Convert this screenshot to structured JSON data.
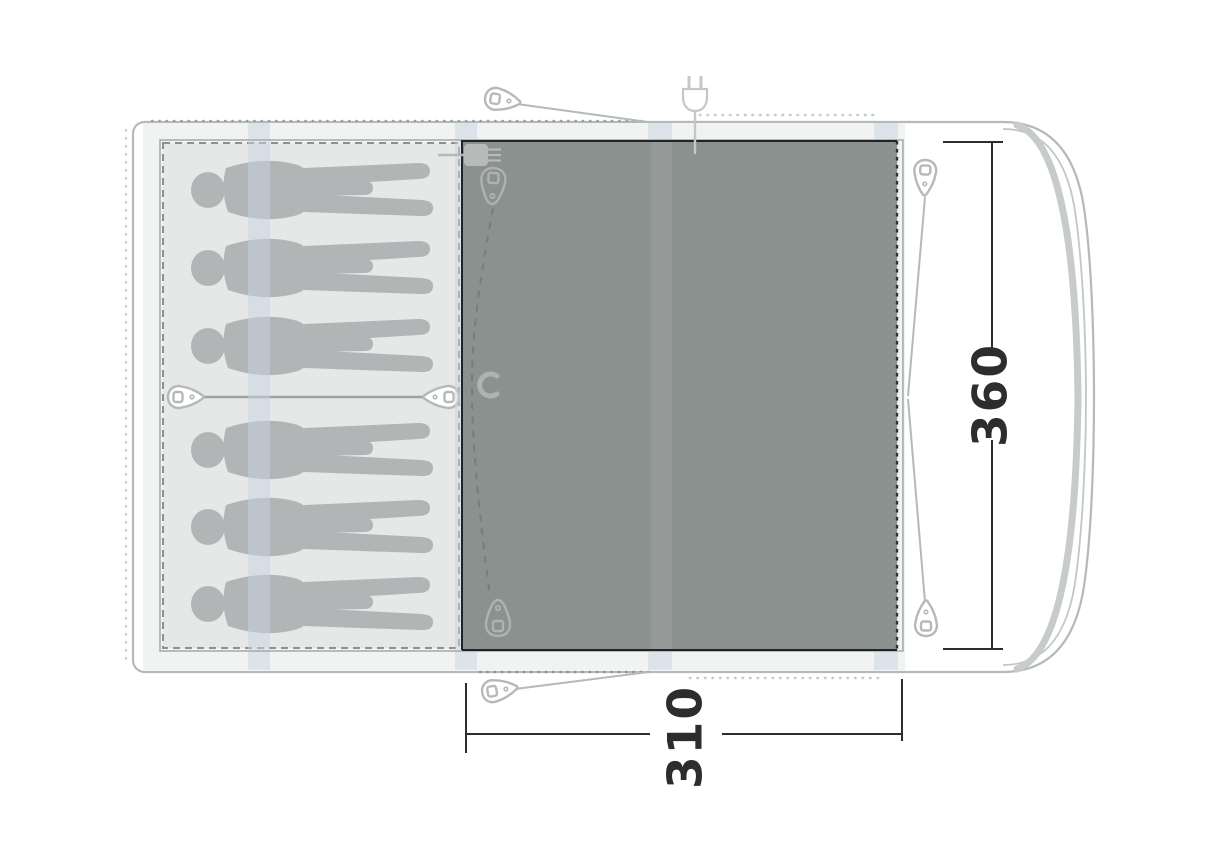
{
  "diagram": {
    "title": "tent floor plan (top view)",
    "dimensions": {
      "depth_label": "360",
      "width_label": "310"
    },
    "sleeping_capacity": 6,
    "areas": {
      "sleeping_area": "sleeping cabin with 6 person silhouettes",
      "living_area": "dark groundsheet living room"
    },
    "icons": [
      "tent-peg-icon",
      "power-plug-icon",
      "zipper-pull-icon",
      "hook-icon",
      "person-silhouette"
    ],
    "colors": {
      "outline": "#b5b9ba",
      "pole_curve": "#c7cbcc",
      "interior_strip": "#f1f2f2",
      "sleeping_fill": "#e6e7e7",
      "cabin_dash_border": "#8c9091",
      "silhouette": "#b2b5b6",
      "living_fill": "#8b918f",
      "living_border": "#212425",
      "pole_sleeve_band": "rgba(199,211,226,0.5)",
      "dimension_line": "#2b2d2e",
      "background": "#ffffff"
    }
  }
}
